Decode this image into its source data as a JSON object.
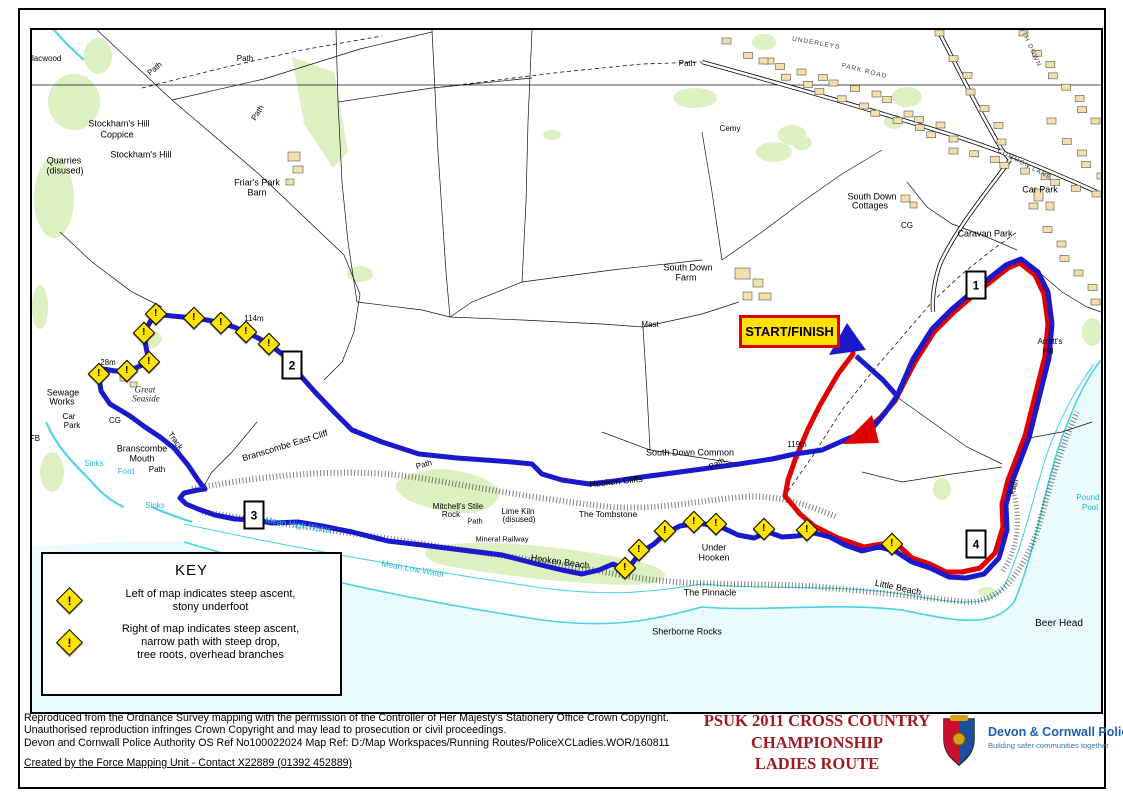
{
  "page": {
    "colors": {
      "route_blue": "#1A1ACC",
      "route_red": "#E00000",
      "sea": "#EAFBFB",
      "shore_cyan": "#49D2E2",
      "stream_cyan": "#55D5E5",
      "woodland_green": "#DCF0C2",
      "building_tan": "#F2DFA9",
      "marker_yellow": "#FFE200",
      "title_red": "#A01820",
      "police_blue": "#1C5FAE",
      "cyan_text": "#1FB9D6"
    },
    "start_finish": {
      "label": "START/FINISH"
    },
    "route_markers": [
      {
        "label": "1",
        "x": 974,
        "y": 283
      },
      {
        "label": "2",
        "x": 290,
        "y": 363
      },
      {
        "label": "3",
        "x": 252,
        "y": 513
      },
      {
        "label": "4",
        "x": 974,
        "y": 542
      }
    ],
    "warning_icon_glyph": "!",
    "warning_markers": [
      [
        97,
        372
      ],
      [
        125,
        369
      ],
      [
        147,
        360
      ],
      [
        142,
        331
      ],
      [
        154,
        312
      ],
      [
        192,
        316
      ],
      [
        219,
        321
      ],
      [
        244,
        330
      ],
      [
        267,
        342
      ],
      [
        623,
        566
      ],
      [
        637,
        548
      ],
      [
        663,
        529
      ],
      [
        692,
        520
      ],
      [
        714,
        522
      ],
      [
        762,
        527
      ],
      [
        805,
        528
      ],
      [
        890,
        542
      ]
    ],
    "labels": [
      {
        "t": "Blacwood",
        "x": 42,
        "y": 57,
        "f": 8
      },
      {
        "t": "Path",
        "x": 153,
        "y": 67,
        "f": 8,
        "r": -40
      },
      {
        "t": "Path",
        "x": 243,
        "y": 57,
        "f": 8
      },
      {
        "t": "Path",
        "x": 256,
        "y": 111,
        "f": 8,
        "r": -58
      },
      {
        "t": "Path",
        "x": 685,
        "y": 62,
        "f": 8
      },
      {
        "t": "Stockham's Hill",
        "x": 117,
        "y": 122
      },
      {
        "t": "Coppice",
        "x": 115,
        "y": 133
      },
      {
        "t": "Stockham's Hill",
        "x": 139,
        "y": 153
      },
      {
        "t": "Quarries",
        "x": 62,
        "y": 159
      },
      {
        "t": "(disused)",
        "x": 63,
        "y": 169
      },
      {
        "t": "Friar's Park",
        "x": 255,
        "y": 181
      },
      {
        "t": "Barn",
        "x": 255,
        "y": 191
      },
      {
        "t": "Cemy",
        "x": 728,
        "y": 127,
        "f": 8
      },
      {
        "t": "UNDERLEYS",
        "x": 814,
        "y": 42,
        "f": 6.5,
        "r": 10,
        "c": "street"
      },
      {
        "t": "PARK ROAD",
        "x": 862,
        "y": 70,
        "f": 6.5,
        "r": 14,
        "c": "street"
      },
      {
        "t": "SOUTH DOWN",
        "x": 1025,
        "y": 40,
        "f": 6.5,
        "r": 65,
        "c": "street"
      },
      {
        "t": "COMMON LANE",
        "x": 1022,
        "y": 163,
        "f": 6.5,
        "r": 28,
        "c": "street"
      },
      {
        "t": "South Down",
        "x": 870,
        "y": 195
      },
      {
        "t": "Cottages",
        "x": 868,
        "y": 204
      },
      {
        "t": "Car Park",
        "x": 1038,
        "y": 188
      },
      {
        "t": "Caravan Park",
        "x": 983,
        "y": 232
      },
      {
        "t": "South Down",
        "x": 686,
        "y": 266
      },
      {
        "t": "Farm",
        "x": 684,
        "y": 276
      },
      {
        "t": "Mast",
        "x": 648,
        "y": 323,
        "f": 8
      },
      {
        "t": "114m",
        "x": 252,
        "y": 317,
        "f": 8
      },
      {
        "t": "28m",
        "x": 106,
        "y": 361,
        "f": 8
      },
      {
        "t": "119m",
        "x": 795,
        "y": 443,
        "f": 8
      },
      {
        "t": "Sewage",
        "x": 61,
        "y": 391
      },
      {
        "t": "Works",
        "x": 60,
        "y": 400
      },
      {
        "t": "Car",
        "x": 67,
        "y": 415,
        "f": 8
      },
      {
        "t": "Park",
        "x": 70,
        "y": 424,
        "f": 8
      },
      {
        "t": "Great",
        "x": 143,
        "y": 388,
        "c": "antique"
      },
      {
        "t": "Seaside",
        "x": 144,
        "y": 397,
        "c": "antique"
      },
      {
        "t": "CG",
        "x": 113,
        "y": 419,
        "f": 8
      },
      {
        "t": "CG",
        "x": 905,
        "y": 224,
        "f": 8
      },
      {
        "t": "Branscombe",
        "x": 140,
        "y": 447
      },
      {
        "t": "Mouth",
        "x": 140,
        "y": 457
      },
      {
        "t": "Track",
        "x": 173,
        "y": 439,
        "f": 8,
        "r": 55
      },
      {
        "t": "Path",
        "x": 155,
        "y": 468,
        "f": 8
      },
      {
        "t": "Ford",
        "x": 124,
        "y": 470,
        "f": 8,
        "c": "water"
      },
      {
        "t": "Sinks",
        "x": 92,
        "y": 462,
        "f": 8,
        "c": "water"
      },
      {
        "t": "Sinks",
        "x": 153,
        "y": 504,
        "f": 8,
        "c": "water"
      },
      {
        "t": "FB",
        "x": 33,
        "y": 437,
        "f": 8
      },
      {
        "t": "Branscombe East Cliff",
        "x": 283,
        "y": 444,
        "r": -17
      },
      {
        "t": "Mean High Water",
        "x": 296,
        "y": 523,
        "f": 8.5,
        "r": 9,
        "c": "water"
      },
      {
        "t": "Mean Low Water",
        "x": 411,
        "y": 567,
        "f": 8.5,
        "r": 10,
        "c": "water"
      },
      {
        "t": "Hooken Cliffs",
        "x": 614,
        "y": 480,
        "r": -6
      },
      {
        "t": "Path",
        "x": 422,
        "y": 463,
        "f": 8,
        "r": -15
      },
      {
        "t": "Path",
        "x": 715,
        "y": 462,
        "f": 8,
        "r": -28
      },
      {
        "t": "South Down Common",
        "x": 688,
        "y": 451
      },
      {
        "t": "Mitchell's Stile",
        "x": 456,
        "y": 505,
        "f": 8
      },
      {
        "t": "Rock",
        "x": 449,
        "y": 513,
        "f": 8
      },
      {
        "t": "Path",
        "x": 473,
        "y": 519,
        "f": 7.5
      },
      {
        "t": "Lime Kiln",
        "x": 516,
        "y": 510,
        "f": 8
      },
      {
        "t": "(disused)",
        "x": 517,
        "y": 518,
        "f": 8
      },
      {
        "t": "Mineral Railway",
        "x": 500,
        "y": 537,
        "f": 7.5
      },
      {
        "t": "The Tombstone",
        "x": 606,
        "y": 512,
        "f": 8.5
      },
      {
        "t": "Under",
        "x": 712,
        "y": 546
      },
      {
        "t": "Hooken",
        "x": 712,
        "y": 556
      },
      {
        "t": "Hooken Beach",
        "x": 558,
        "y": 560,
        "r": 8
      },
      {
        "t": "The Pinnacle",
        "x": 708,
        "y": 591
      },
      {
        "t": "Sherborne Rocks",
        "x": 685,
        "y": 630
      },
      {
        "t": "Little Beach",
        "x": 896,
        "y": 586,
        "r": 12
      },
      {
        "t": "Beer Head",
        "x": 1057,
        "y": 622,
        "f": 10
      },
      {
        "t": "Pound",
        "x": 1086,
        "y": 496,
        "f": 8,
        "c": "water"
      },
      {
        "t": "Pool",
        "x": 1088,
        "y": 506,
        "f": 8,
        "c": "water"
      },
      {
        "t": "Arratt's",
        "x": 1048,
        "y": 340,
        "f": 8
      },
      {
        "t": "Hill",
        "x": 1046,
        "y": 350,
        "f": 8
      },
      {
        "t": "Path",
        "x": 1012,
        "y": 485,
        "f": 7.5,
        "r": -72
      }
    ],
    "routes": {
      "blue": [
        [
          854,
          354
        ],
        [
          881,
          378
        ],
        [
          895,
          394
        ],
        [
          911,
          357
        ],
        [
          930,
          327
        ],
        [
          950,
          307
        ],
        [
          976,
          285
        ],
        [
          1004,
          263
        ],
        [
          1019,
          257
        ],
        [
          1036,
          270
        ],
        [
          1046,
          290
        ],
        [
          1050,
          322
        ],
        [
          1047,
          356
        ],
        [
          1037,
          396
        ],
        [
          1027,
          436
        ],
        [
          1010,
          480
        ],
        [
          1004,
          503
        ],
        [
          1005,
          528
        ],
        [
          997,
          556
        ],
        [
          982,
          572
        ],
        [
          964,
          576
        ],
        [
          947,
          575
        ],
        [
          928,
          566
        ],
        [
          910,
          560
        ],
        [
          893,
          549
        ],
        [
          877,
          545
        ],
        [
          860,
          549
        ],
        [
          843,
          543
        ],
        [
          828,
          535
        ],
        [
          812,
          531
        ],
        [
          795,
          534
        ],
        [
          780,
          535
        ],
        [
          766,
          530
        ],
        [
          752,
          536
        ],
        [
          736,
          533
        ],
        [
          717,
          524
        ],
        [
          695,
          521
        ],
        [
          678,
          524
        ],
        [
          664,
          531
        ],
        [
          652,
          542
        ],
        [
          638,
          551
        ],
        [
          625,
          568
        ],
        [
          611,
          562
        ],
        [
          597,
          568
        ],
        [
          580,
          572
        ],
        [
          560,
          568
        ],
        [
          535,
          562
        ],
        [
          500,
          553
        ],
        [
          460,
          548
        ],
        [
          420,
          543
        ],
        [
          386,
          539
        ],
        [
          350,
          530
        ],
        [
          320,
          524
        ],
        [
          296,
          520
        ],
        [
          270,
          521
        ],
        [
          252,
          518
        ],
        [
          233,
          517
        ],
        [
          213,
          513
        ],
        [
          196,
          507
        ],
        [
          184,
          502
        ],
        [
          178,
          496
        ],
        [
          182,
          491
        ],
        [
          196,
          488
        ],
        [
          203,
          487
        ],
        [
          196,
          478
        ],
        [
          186,
          463
        ],
        [
          172,
          446
        ],
        [
          158,
          435
        ],
        [
          143,
          425
        ],
        [
          128,
          414
        ],
        [
          108,
          402
        ],
        [
          99,
          389
        ],
        [
          97,
          375
        ],
        [
          101,
          367
        ],
        [
          113,
          369
        ],
        [
          125,
          369
        ],
        [
          136,
          365
        ],
        [
          147,
          360
        ],
        [
          144,
          345
        ],
        [
          142,
          331
        ],
        [
          148,
          320
        ],
        [
          154,
          312
        ],
        [
          170,
          314
        ],
        [
          192,
          316
        ],
        [
          205,
          318
        ],
        [
          219,
          321
        ],
        [
          232,
          325
        ],
        [
          244,
          330
        ],
        [
          256,
          336
        ],
        [
          267,
          342
        ],
        [
          280,
          352
        ],
        [
          290,
          362
        ],
        [
          297,
          372
        ],
        [
          313,
          390
        ],
        [
          332,
          410
        ],
        [
          350,
          428
        ],
        [
          380,
          440
        ],
        [
          417,
          452
        ],
        [
          455,
          456
        ],
        [
          483,
          458
        ],
        [
          510,
          460
        ],
        [
          530,
          462
        ],
        [
          540,
          472
        ],
        [
          560,
          478
        ],
        [
          587,
          482
        ],
        [
          605,
          480
        ],
        [
          620,
          478
        ],
        [
          640,
          475
        ],
        [
          663,
          472
        ],
        [
          700,
          467
        ],
        [
          737,
          462
        ],
        [
          770,
          457
        ],
        [
          793,
          452
        ],
        [
          820,
          448
        ],
        [
          845,
          437
        ],
        [
          869,
          428
        ],
        [
          883,
          411
        ],
        [
          895,
          394
        ]
      ],
      "red": [
        [
          849,
          334
        ],
        [
          851,
          352
        ],
        [
          836,
          372
        ],
        [
          818,
          403
        ],
        [
          806,
          427
        ],
        [
          793,
          458
        ],
        [
          786,
          478
        ],
        [
          783,
          494
        ],
        [
          798,
          512
        ],
        [
          812,
          524
        ],
        [
          836,
          536
        ],
        [
          862,
          545
        ],
        [
          880,
          542
        ],
        [
          896,
          543
        ],
        [
          910,
          556
        ],
        [
          928,
          562
        ],
        [
          944,
          570
        ],
        [
          960,
          570
        ],
        [
          978,
          566
        ],
        [
          993,
          551
        ],
        [
          1001,
          525
        ],
        [
          1000,
          502
        ],
        [
          1006,
          478
        ],
        [
          1023,
          434
        ],
        [
          1033,
          394
        ],
        [
          1043,
          354
        ],
        [
          1046,
          322
        ],
        [
          1042,
          292
        ],
        [
          1033,
          273
        ],
        [
          1018,
          261
        ],
        [
          1006,
          266
        ],
        [
          978,
          288
        ],
        [
          952,
          310
        ],
        [
          932,
          330
        ],
        [
          913,
          360
        ],
        [
          899,
          387
        ],
        [
          893,
          399
        ],
        [
          878,
          416
        ],
        [
          862,
          429
        ],
        [
          850,
          437
        ]
      ],
      "blue_arrow": "845,321 827,353 864,348",
      "red_arrow": "841,442 870,413 877,441"
    },
    "key": {
      "title": "KEY",
      "items": [
        {
          "lines": [
            "Left of map indicates steep ascent,",
            "stony underfoot"
          ]
        },
        {
          "lines": [
            "Right of map indicates steep ascent,",
            "narrow path with steep drop,",
            "tree roots, overhead branches"
          ]
        }
      ]
    },
    "footer": {
      "copyright_lines": [
        "Reproduced from the Ordnance Survey mapping with the permission of the Controller of Her Majesty's Stationery Office Crown Copyright.",
        "Unauthorised reproduction infringes Crown Copyright and may lead to prosecution or civil proceedings.",
        "Devon and Cornwall Police Authority OS Ref No100022024   Map Ref: D:/Map Workspaces/Running  Routes/PoliceXCLadies.WOR/160811"
      ],
      "created_by": "Created by the Force Mapping Unit - Contact X22889 (01392 452889)",
      "title_lines": [
        "PSUK 2011 CROSS COUNTRY",
        "CHAMPIONSHIP",
        "LADIES ROUTE"
      ],
      "logo": {
        "org": "Devon & Cornwall Police",
        "tagline": "Building safer communities together"
      }
    }
  }
}
